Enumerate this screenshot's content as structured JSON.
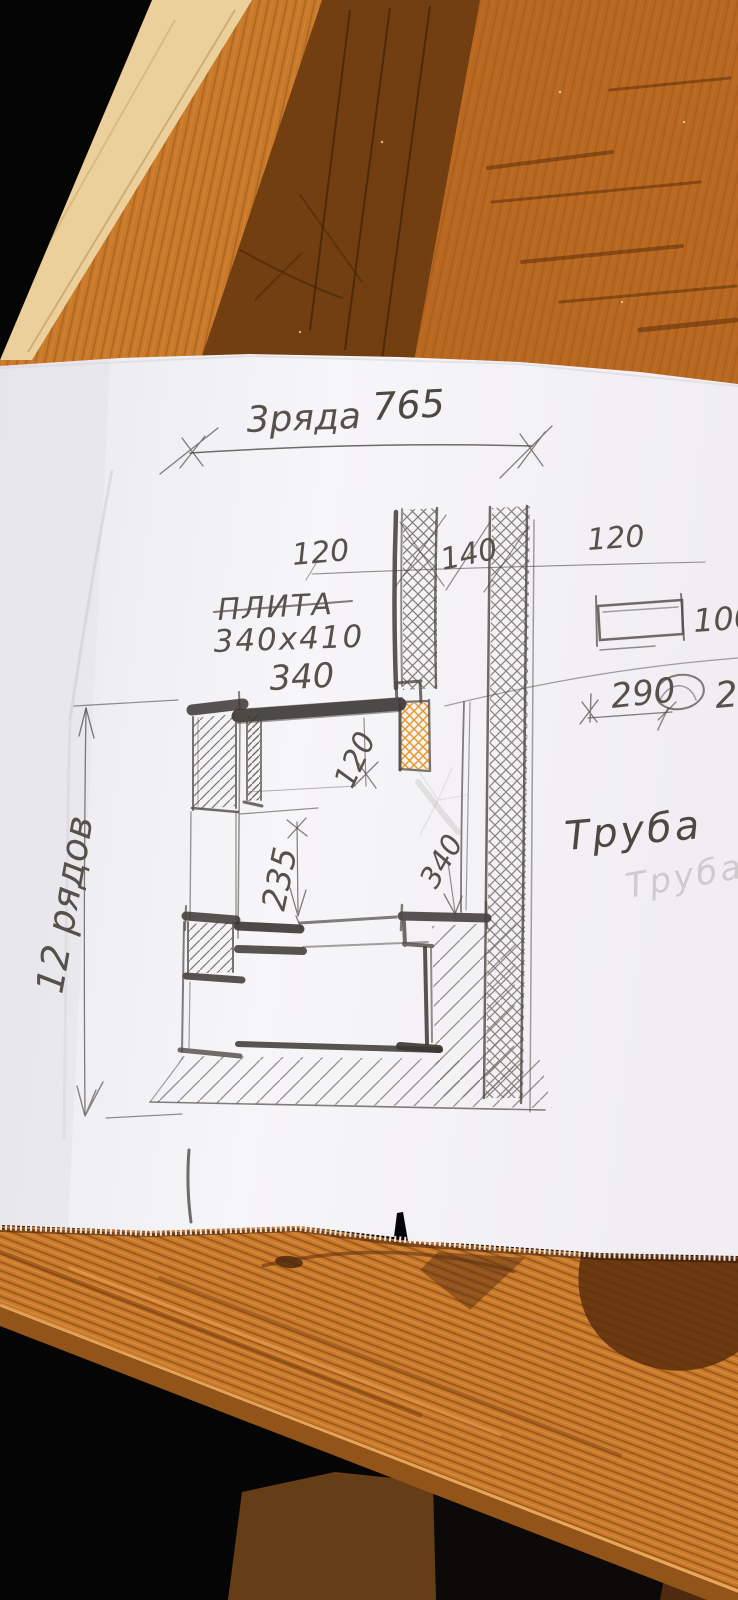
{
  "sketch": {
    "top_dimension": {
      "rows_label": "3ряда",
      "value": "765"
    },
    "upper_dims": {
      "left": "120",
      "middle": "140",
      "right": "120"
    },
    "plate": {
      "name": "ПЛИТА",
      "size": "340х410",
      "width_label": "340"
    },
    "inner_dims": {
      "gap": "120",
      "height": "235",
      "depth": "340"
    },
    "left_dimension": {
      "rows": "12 рядов"
    },
    "chimney": {
      "label": "Труба",
      "ghost_label": "Труба"
    },
    "brick_note": {
      "length": "100",
      "width": "290",
      "extra": "2"
    }
  },
  "colors": {
    "wood_base": "#c9792a",
    "wood_dark_band": "#6e3c11",
    "wood_edge_light": "#ecd09c",
    "background_black": "#060505",
    "paper": "#f4f3f6",
    "pencil": "#4e4843",
    "pencil_dark": "#3b3632",
    "orange_pencil": "#e8941f"
  }
}
